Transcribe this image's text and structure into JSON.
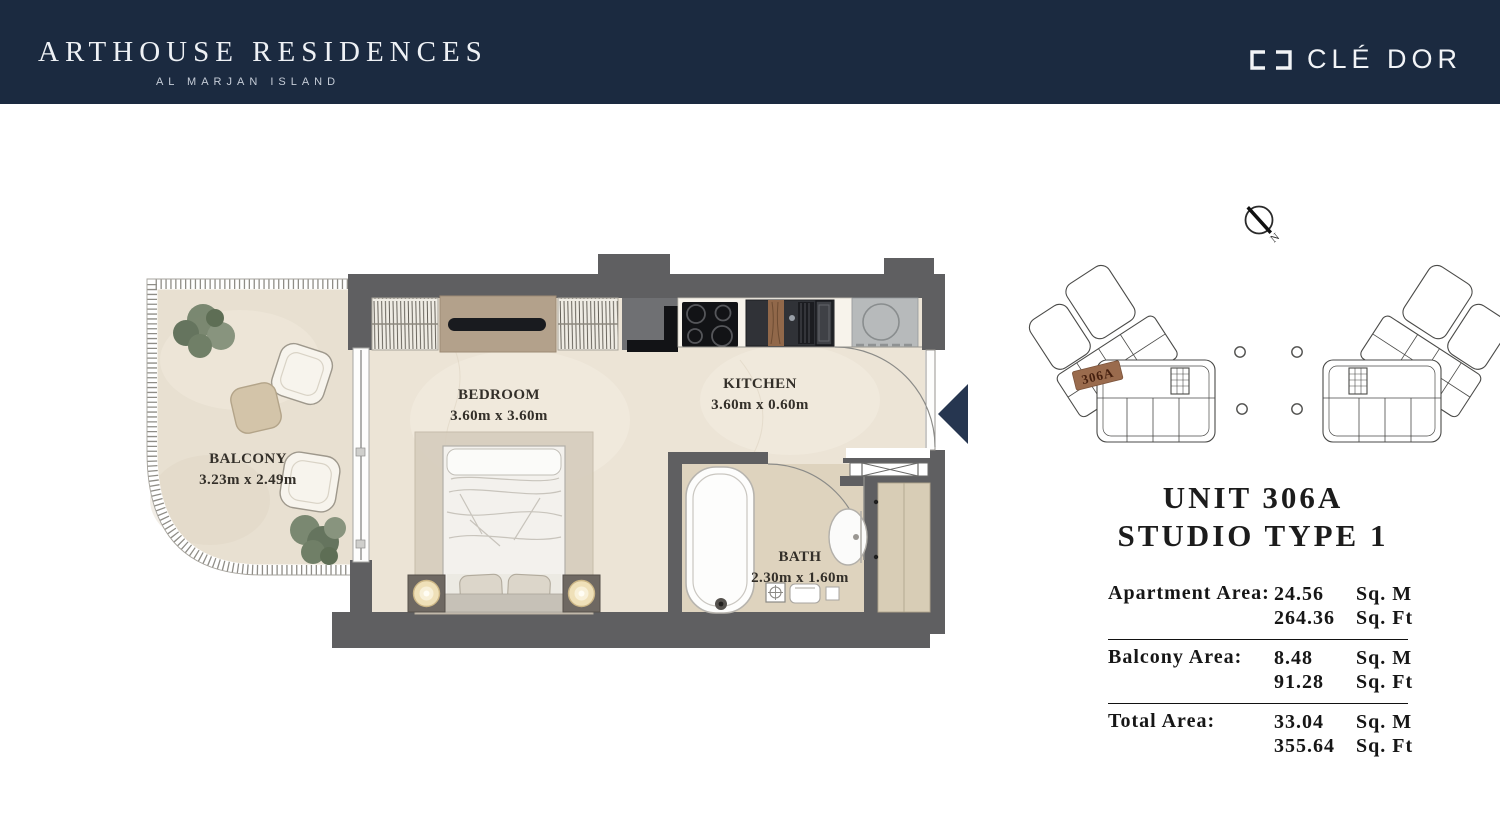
{
  "header": {
    "brand": "ARTHOUSE RESIDENCES",
    "sub_brand": "AL MARJAN ISLAND",
    "logo_text": "CLÉ DOR",
    "bg_color": "#1b2a40"
  },
  "floor_plan": {
    "rooms": [
      {
        "name": "BALCONY",
        "dims": "3.23m x 2.49m"
      },
      {
        "name": "BEDROOM",
        "dims": "3.60m x 3.60m"
      },
      {
        "name": "KITCHEN",
        "dims": "3.60m x 0.60m"
      },
      {
        "name": "BATH",
        "dims": "2.30m x 1.60m"
      }
    ]
  },
  "key_plan": {
    "highlighted_unit": "306A",
    "highlight_color": "#9a6b4d"
  },
  "north_indicator": {
    "label": "N"
  },
  "unit_info": {
    "title": "UNIT 306A",
    "subtitle": "STUDIO TYPE 1",
    "areas": [
      {
        "label": "Apartment Area:",
        "metric_value": "24.56",
        "metric_unit": "Sq. M",
        "imperial_value": "264.36",
        "imperial_unit": "Sq. Ft"
      },
      {
        "label": "Balcony Area:",
        "metric_value": "8.48",
        "metric_unit": "Sq. M",
        "imperial_value": "91.28",
        "imperial_unit": "Sq. Ft"
      },
      {
        "label": "Total Area:",
        "metric_value": "33.04",
        "metric_unit": "Sq. M",
        "imperial_value": "355.64",
        "imperial_unit": "Sq. Ft"
      }
    ]
  }
}
